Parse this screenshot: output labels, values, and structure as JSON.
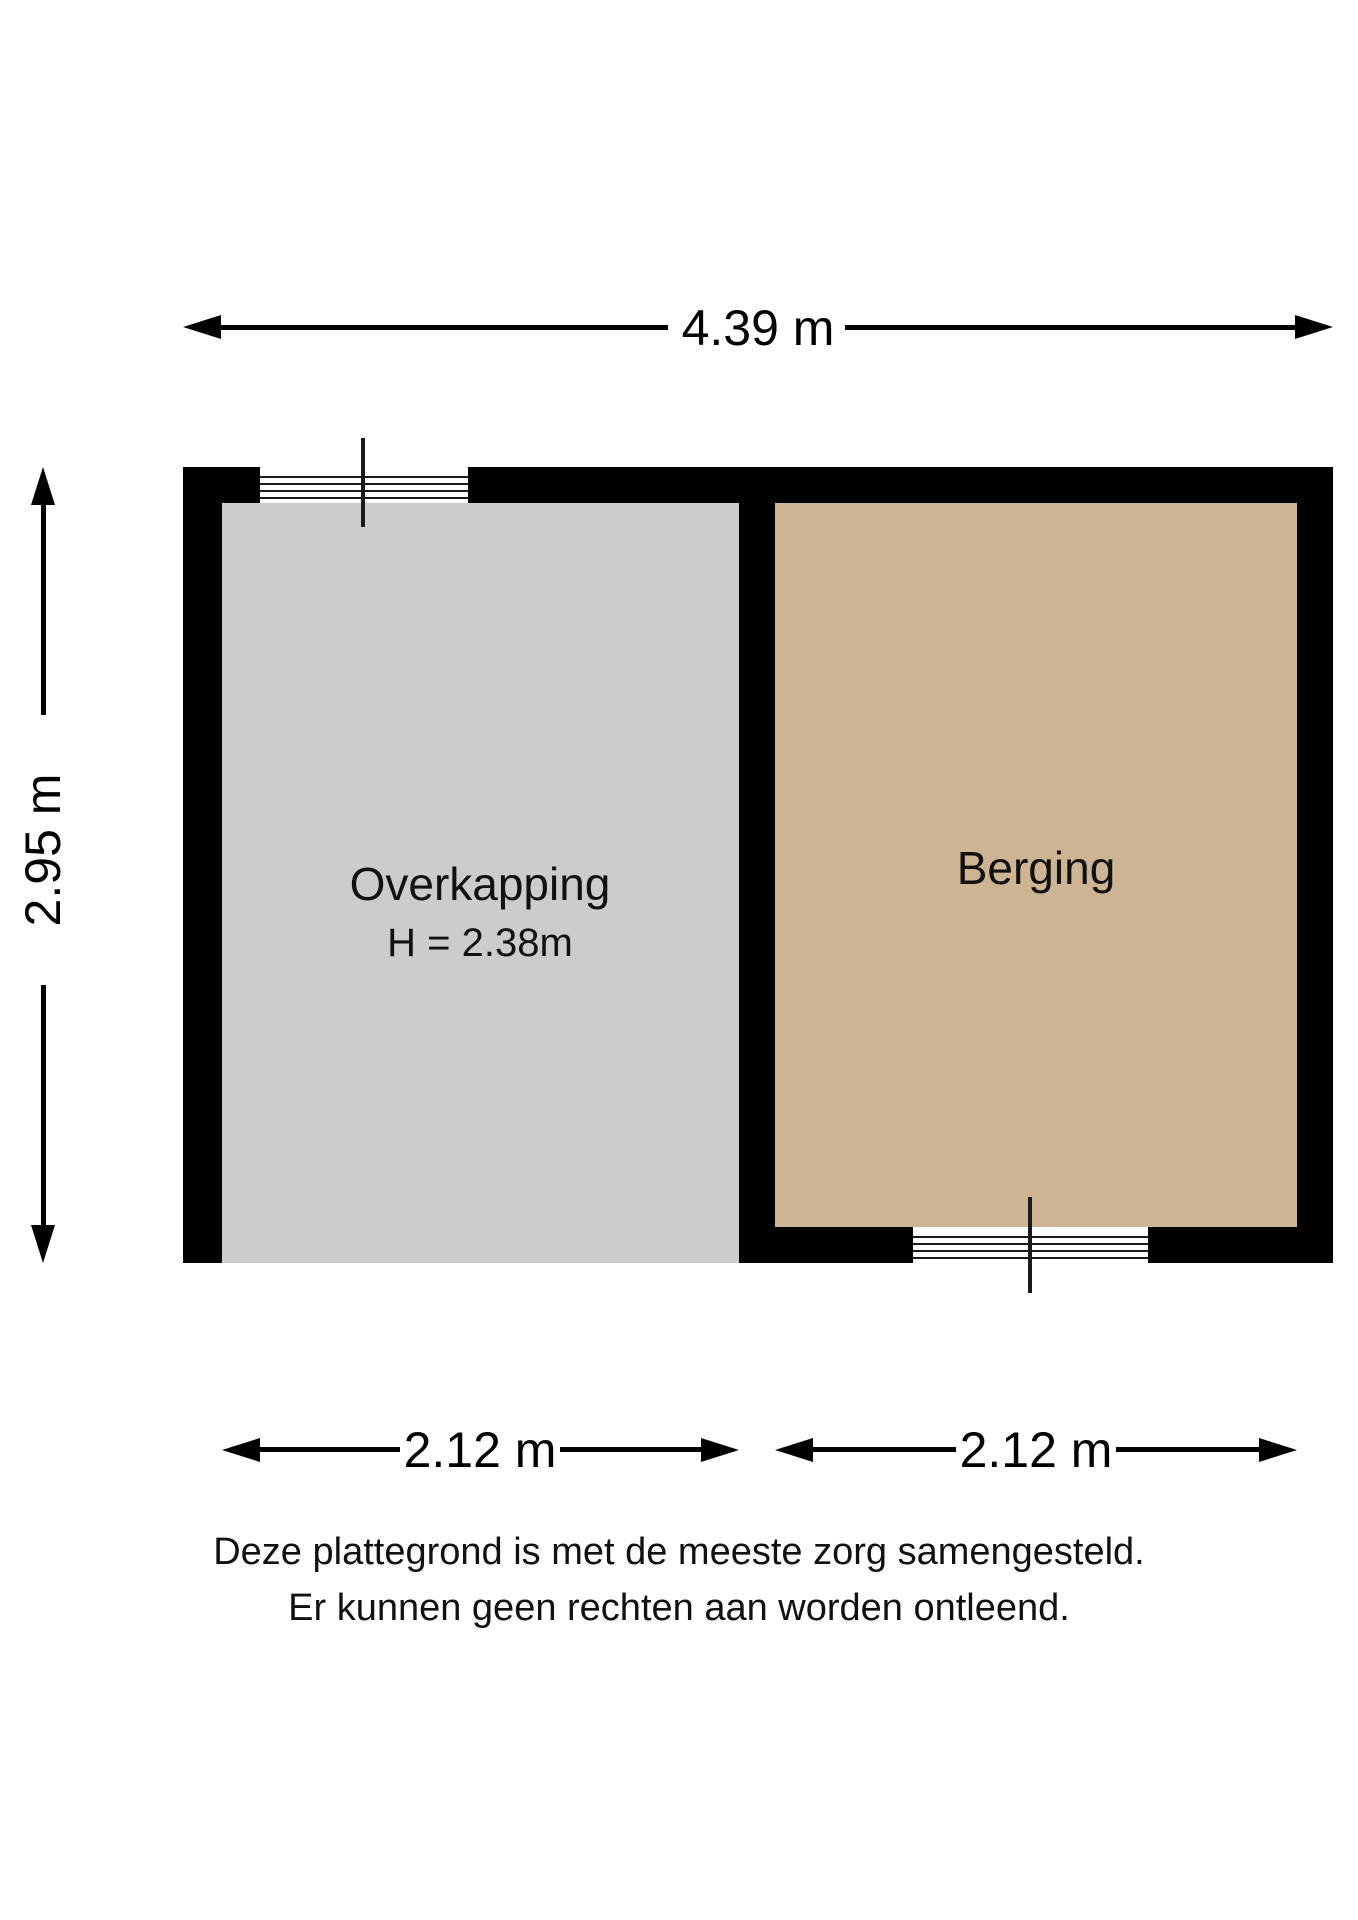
{
  "plan": {
    "type": "floorplan",
    "colors": {
      "wall": "#000000",
      "background": "#ffffff",
      "overkapping_fill": "#cccccc",
      "berging_fill": "#cdb593"
    },
    "rooms": [
      {
        "name": "Overkapping",
        "height_label": "H = 2.38m",
        "fill": "#cccccc"
      },
      {
        "name": "Berging",
        "fill": "#cdb593"
      }
    ],
    "dimensions": {
      "top": {
        "label": "4.39 m"
      },
      "left": {
        "label": "2.95 m"
      },
      "bottom_left": {
        "label": "2.12 m"
      },
      "bottom_right": {
        "label": "2.12 m"
      }
    },
    "disclaimer": {
      "line1": "Deze plattegrond is met de meeste zorg samengesteld.",
      "line2": "Er kunnen geen rechten aan worden ontleend."
    }
  }
}
